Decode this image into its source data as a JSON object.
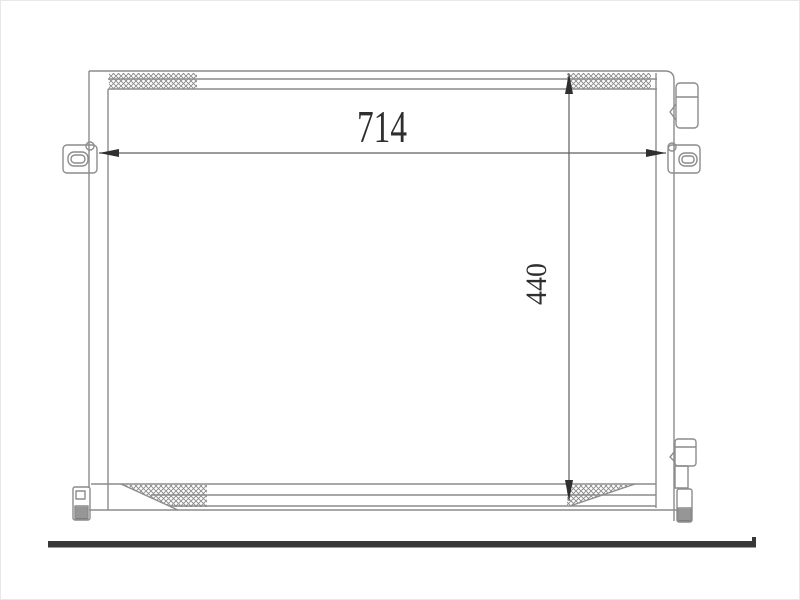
{
  "drawing": {
    "type": "technical-drawing",
    "subject": "condenser-front-view",
    "dimension_labels": {
      "horizontal": "714",
      "vertical": "440"
    },
    "colors": {
      "background": "#ffffff",
      "line_gray": "#8c8c8c",
      "hatch_gray": "#8a8a8a",
      "dimension_line": "#5f5f5f",
      "dimension_dark": "#2f2f2f",
      "baseline_bar": "#383838"
    }
  }
}
